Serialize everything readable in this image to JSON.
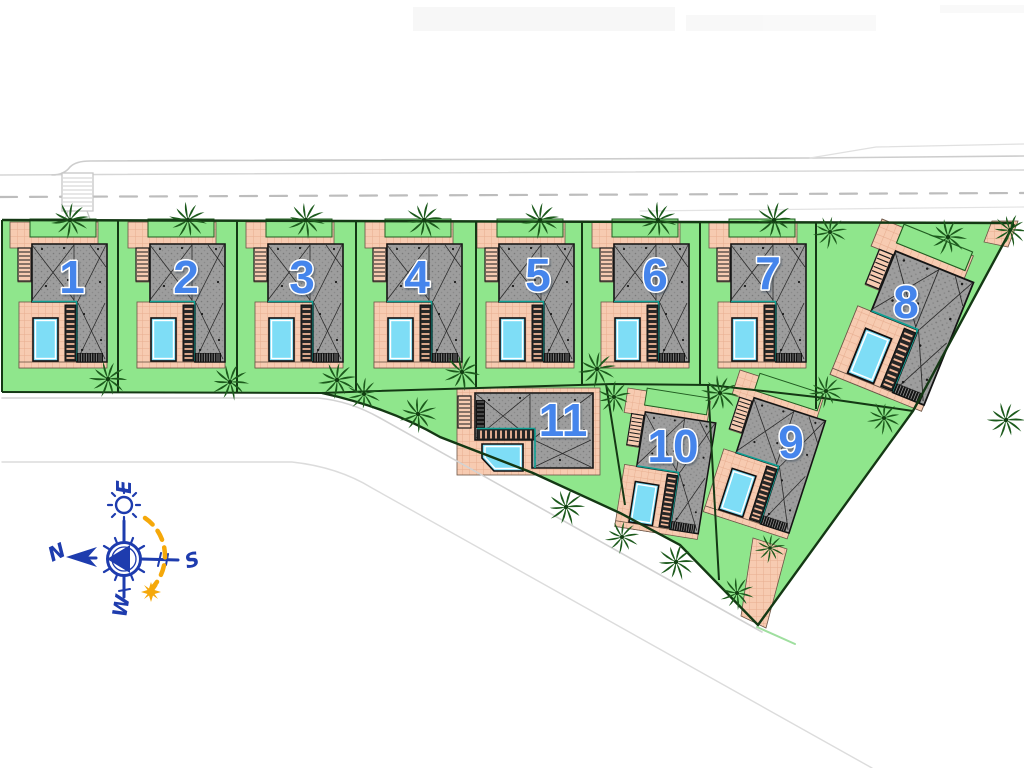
{
  "site_plan": {
    "plots": [
      {
        "label": "1"
      },
      {
        "label": "2"
      },
      {
        "label": "3"
      },
      {
        "label": "4"
      },
      {
        "label": "5"
      },
      {
        "label": "6"
      },
      {
        "label": "7"
      },
      {
        "label": "8"
      },
      {
        "label": "9"
      },
      {
        "label": "10"
      },
      {
        "label": "11"
      }
    ],
    "compass": {
      "north": "N",
      "south": "S",
      "east": "E",
      "west": "W"
    },
    "colors": {
      "lawn": "#8FE68C",
      "paving": "#F7CBB1",
      "paving_grid": "#E7AE90",
      "roof": "#9D9D9D",
      "pool_water": "#7EDDF6",
      "pool_trim": "#FFFFFF",
      "deck_teal": "#0FA093",
      "palm_green": "#1C5A1C",
      "boundary_green": "#143814",
      "plot_number_blue": "#4585EC",
      "compass_blue": "#1E3CAE",
      "sun_yellow": "#F5A80A",
      "road_gray": "#C9C9C9"
    }
  }
}
